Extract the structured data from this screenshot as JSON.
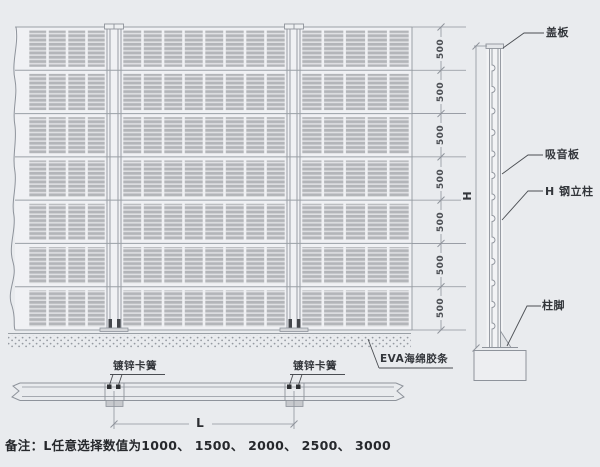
{
  "page": {
    "background": "#e9ebee"
  },
  "drawing": {
    "note": "备注：L任意选择数值为1000、 1500、 2000、 2500、 3000",
    "front_view": {
      "rows": 7,
      "panel_columns": [
        4,
        8,
        5
      ],
      "height_labels": [
        "500",
        "500",
        "500",
        "500",
        "500",
        "500",
        "500"
      ]
    },
    "side_view": {
      "labels": {
        "cover_plate": "盖板",
        "absorber": "吸音板",
        "column": "H 钢立柱",
        "base": "柱脚"
      },
      "height_label": "H"
    },
    "plan_view": {
      "clip_label_left": "镀锌卡簧",
      "clip_label_right": "镀锌卡簧",
      "eva_label": "EVA海绵胶条",
      "length_label": "L"
    },
    "colors": {
      "line": "#8e939b",
      "slat": "#b3b5b9",
      "slat_gap": "#dfe0e3",
      "dark": "#3a3d42",
      "text": "#33363b",
      "background": "#e9ebee"
    }
  }
}
